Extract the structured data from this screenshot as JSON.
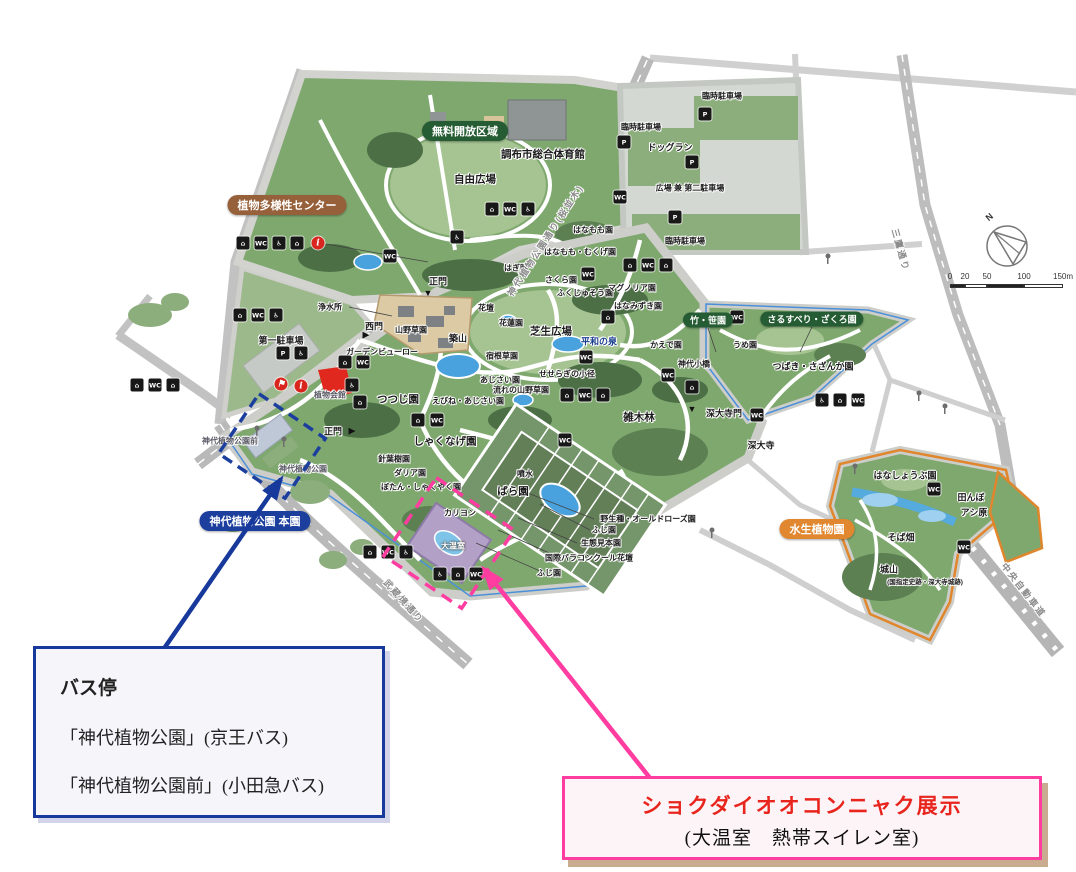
{
  "figure": {
    "width": 1076,
    "height": 872
  },
  "colors": {
    "park_green": "#7fa86f",
    "lawn_green": "#a5c492",
    "tree_green": "#4c6f45",
    "parking_grey": "#d4d8d2",
    "water_blue": "#49a2de",
    "accent_blue": "#16399b",
    "accent_pink": "#ff3da0",
    "red_text": "#e8251d",
    "orange_border": "#e0862c",
    "pill_green": "#265c33",
    "pill_brown": "#96603a",
    "pill_blue": "#1c3f9e",
    "pill_orange": "#e1872f"
  },
  "pills": [
    {
      "t": "無料開放区域",
      "x": 465,
      "y": 131,
      "bg": "#265c33",
      "n": "free-open-area-pill"
    },
    {
      "t": "植物多様性センター",
      "x": 287,
      "y": 205,
      "bg": "#96603a",
      "n": "biodiversity-center-pill"
    },
    {
      "t": "竹・笹園",
      "x": 708,
      "y": 320,
      "bg": "#265c33",
      "small": true,
      "n": "bamboo-garden-pill"
    },
    {
      "t": "さるすべり・ざくろ園",
      "x": 812,
      "y": 319,
      "bg": "#265c33",
      "small": true,
      "n": "crape-myrtle-garden-pill"
    },
    {
      "t": "神代植物公園 本園",
      "x": 255,
      "y": 521,
      "bg": "#1c3f9e",
      "n": "main-garden-pill"
    },
    {
      "t": "水生植物園",
      "x": 817,
      "y": 529,
      "bg": "#e1872f",
      "n": "aquatic-garden-pill"
    }
  ],
  "map": {
    "labels": [
      {
        "t": "臨時駐車場",
        "x": 722,
        "y": 96,
        "c": "s8"
      },
      {
        "t": "臨時駐車場",
        "x": 641,
        "y": 127,
        "c": "s8"
      },
      {
        "t": "ドッグラン",
        "x": 670,
        "y": 147
      },
      {
        "t": "広場 兼 第二駐車場",
        "x": 690,
        "y": 188,
        "c": "s8"
      },
      {
        "t": "臨時駐車場",
        "x": 685,
        "y": 241,
        "c": "s8"
      },
      {
        "t": "調布市総合体育館",
        "x": 543,
        "y": 154,
        "c": "s10"
      },
      {
        "t": "自由広場",
        "x": 475,
        "y": 179,
        "c": "s10"
      },
      {
        "t": "はなもも園",
        "x": 593,
        "y": 230,
        "c": "s8"
      },
      {
        "t": "はなもも・むくげ園",
        "x": 580,
        "y": 252,
        "c": "s8"
      },
      {
        "t": "はぎ園",
        "x": 516,
        "y": 268,
        "c": "s8"
      },
      {
        "t": "さくら園",
        "x": 561,
        "y": 280,
        "c": "s8"
      },
      {
        "t": "ふくじゅそう園",
        "x": 585,
        "y": 293,
        "c": "s8"
      },
      {
        "t": "マグノリア園",
        "x": 632,
        "y": 288,
        "c": "s8"
      },
      {
        "t": "はなみずき園",
        "x": 638,
        "y": 306,
        "c": "s8"
      },
      {
        "t": "正門",
        "x": 438,
        "y": 281
      },
      {
        "t": "▼",
        "x": 428,
        "y": 293,
        "c": "tri"
      },
      {
        "t": "西門",
        "x": 374,
        "y": 326
      },
      {
        "t": "▶",
        "x": 366,
        "y": 335,
        "c": "tri"
      },
      {
        "t": "浄水所",
        "x": 330,
        "y": 307,
        "c": "s8"
      },
      {
        "t": "第一駐車場",
        "x": 281,
        "y": 340
      },
      {
        "t": "ガーデンビューロー",
        "x": 382,
        "y": 352,
        "c": "s8"
      },
      {
        "t": "植物会館",
        "x": 330,
        "y": 395,
        "c": "g8"
      },
      {
        "t": "山野草園",
        "x": 411,
        "y": 330,
        "c": "s8"
      },
      {
        "t": "築山",
        "x": 458,
        "y": 338
      },
      {
        "t": "花壇",
        "x": 486,
        "y": 308,
        "c": "s8"
      },
      {
        "t": "花蓮園",
        "x": 511,
        "y": 323,
        "c": "s8"
      },
      {
        "t": "芝生広場",
        "x": 551,
        "y": 331,
        "c": "s10"
      },
      {
        "t": "宿根草園",
        "x": 502,
        "y": 356,
        "c": "s8"
      },
      {
        "t": "平和の泉",
        "x": 599,
        "y": 341,
        "c": "navy"
      },
      {
        "t": "あじさい園",
        "x": 500,
        "y": 380,
        "c": "s8"
      },
      {
        "t": "流れの山野草園",
        "x": 521,
        "y": 390,
        "c": "s8"
      },
      {
        "t": "えびね・あじさい園",
        "x": 468,
        "y": 401,
        "c": "s8"
      },
      {
        "t": "せせらぎの小径",
        "x": 567,
        "y": 374,
        "c": "s8"
      },
      {
        "t": "つつじ園",
        "x": 398,
        "y": 399,
        "c": "s10"
      },
      {
        "t": "しゃくなげ園",
        "x": 445,
        "y": 441,
        "c": "s10"
      },
      {
        "t": "針葉樹園",
        "x": 394,
        "y": 459,
        "c": "s8"
      },
      {
        "t": "ダリア園",
        "x": 410,
        "y": 473,
        "c": "s8"
      },
      {
        "t": "ぼたん・しゃくやく園",
        "x": 421,
        "y": 487,
        "c": "s8"
      },
      {
        "t": "噴水",
        "x": 525,
        "y": 474,
        "c": "s8"
      },
      {
        "t": "ばら園",
        "x": 513,
        "y": 491,
        "c": "s10"
      },
      {
        "t": "カリヨン",
        "x": 460,
        "y": 513,
        "c": "s8"
      },
      {
        "t": "大温室",
        "x": 453,
        "y": 546,
        "c": "w8"
      },
      {
        "t": "野生種・オールドローズ園",
        "x": 648,
        "y": 519,
        "c": "s8"
      },
      {
        "t": "ふじ園",
        "x": 604,
        "y": 530,
        "c": "s8"
      },
      {
        "t": "生態見本園",
        "x": 601,
        "y": 543,
        "c": "s8"
      },
      {
        "t": "国際バラコンクール花壇",
        "x": 589,
        "y": 558,
        "c": "s8"
      },
      {
        "t": "ふじ園",
        "x": 549,
        "y": 573,
        "c": "s8"
      },
      {
        "t": "雑木林",
        "x": 639,
        "y": 417,
        "c": "s10"
      },
      {
        "t": "深大寺門",
        "x": 724,
        "y": 413
      },
      {
        "t": "▼",
        "x": 692,
        "y": 409,
        "c": "tri"
      },
      {
        "t": "深大寺",
        "x": 761,
        "y": 445
      },
      {
        "t": "かえで園",
        "x": 666,
        "y": 345,
        "c": "s8"
      },
      {
        "t": "神代小橋",
        "x": 694,
        "y": 364,
        "c": "s8"
      },
      {
        "t": "うめ園",
        "x": 745,
        "y": 345,
        "c": "s8"
      },
      {
        "t": "つばき・さざんか園",
        "x": 813,
        "y": 366
      },
      {
        "t": "はなしょうぶ園",
        "x": 905,
        "y": 475
      },
      {
        "t": "田んぼ",
        "x": 971,
        "y": 497
      },
      {
        "t": "アシ原",
        "x": 974,
        "y": 512
      },
      {
        "t": "そば畑",
        "x": 901,
        "y": 537
      },
      {
        "t": "城山",
        "x": 889,
        "y": 569
      },
      {
        "t": "(国指定史跡・深大寺城跡)",
        "x": 925,
        "y": 581,
        "c": "s7"
      },
      {
        "t": "正門",
        "x": 333,
        "y": 431
      },
      {
        "t": "▶",
        "x": 352,
        "y": 431,
        "c": "tri"
      },
      {
        "t": "神代植物公園前",
        "x": 230,
        "y": 441,
        "c": "g8"
      },
      {
        "t": "神代植物公園",
        "x": 303,
        "y": 469,
        "c": "g8"
      },
      {
        "t": "神代植物公園通り(桜並木)",
        "x": 545,
        "y": 240,
        "c": "road",
        "r": -57
      },
      {
        "t": "三鷹通り",
        "x": 901,
        "y": 250,
        "c": "road",
        "r": 74
      },
      {
        "t": "武蔵境通り",
        "x": 404,
        "y": 601,
        "c": "road",
        "r": 48
      },
      {
        "t": "中央自動車道",
        "x": 1024,
        "y": 590,
        "c": "road",
        "r": 52
      }
    ],
    "icons": [
      {
        "n": "facility-icon",
        "g": "⌂",
        "x": 243,
        "y": 243
      },
      {
        "n": "toilet-icon",
        "g": "WC",
        "x": 261,
        "y": 243
      },
      {
        "n": "accessible-icon",
        "g": "♿",
        "x": 279,
        "y": 243
      },
      {
        "n": "facility-icon",
        "g": "⌂",
        "x": 297,
        "y": 243
      },
      {
        "n": "info-icon",
        "g": "i",
        "x": 318,
        "y": 243,
        "red": true
      },
      {
        "n": "facility-icon",
        "g": "⌂",
        "x": 240,
        "y": 315
      },
      {
        "n": "toilet-icon",
        "g": "WC",
        "x": 258,
        "y": 315
      },
      {
        "n": "accessible-icon",
        "g": "♿",
        "x": 276,
        "y": 315
      },
      {
        "n": "parking-icon",
        "g": "P",
        "x": 283,
        "y": 353
      },
      {
        "n": "accessible-icon",
        "g": "♿",
        "x": 301,
        "y": 353
      },
      {
        "n": "facility-icon",
        "g": "⌂",
        "x": 137,
        "y": 385
      },
      {
        "n": "toilet-icon",
        "g": "WC",
        "x": 155,
        "y": 385
      },
      {
        "n": "facility-icon",
        "g": "⌂",
        "x": 173,
        "y": 385
      },
      {
        "n": "flag-icon",
        "g": "⚑",
        "x": 281,
        "y": 384,
        "red": true
      },
      {
        "n": "info-icon",
        "g": "i",
        "x": 301,
        "y": 386,
        "red": true
      },
      {
        "n": "toilet-icon",
        "g": "WC",
        "x": 390,
        "y": 256
      },
      {
        "n": "accessible-icon",
        "g": "♿",
        "x": 457,
        "y": 237
      },
      {
        "n": "facility-icon",
        "g": "⌂",
        "x": 492,
        "y": 209
      },
      {
        "n": "toilet-icon",
        "g": "WC",
        "x": 510,
        "y": 209
      },
      {
        "n": "accessible-icon",
        "g": "♿",
        "x": 528,
        "y": 209
      },
      {
        "n": "parking-icon",
        "g": "P",
        "x": 705,
        "y": 114
      },
      {
        "n": "parking-icon",
        "g": "P",
        "x": 624,
        "y": 142
      },
      {
        "n": "parking-icon",
        "g": "P",
        "x": 692,
        "y": 162
      },
      {
        "n": "parking-icon",
        "g": "P",
        "x": 675,
        "y": 217
      },
      {
        "n": "toilet-icon",
        "g": "WC",
        "x": 620,
        "y": 197
      },
      {
        "n": "facility-icon",
        "g": "⌂",
        "x": 630,
        "y": 265
      },
      {
        "n": "toilet-icon",
        "g": "WC",
        "x": 648,
        "y": 265
      },
      {
        "n": "facility-icon",
        "g": "⌂",
        "x": 666,
        "y": 265
      },
      {
        "n": "toilet-icon",
        "g": "WC",
        "x": 588,
        "y": 274
      },
      {
        "n": "facility-icon",
        "g": "⌂",
        "x": 608,
        "y": 317
      },
      {
        "n": "toilet-icon",
        "g": "WC",
        "x": 586,
        "y": 357
      },
      {
        "n": "facility-icon",
        "g": "⌂",
        "x": 345,
        "y": 362
      },
      {
        "n": "toilet-icon",
        "g": "WC",
        "x": 363,
        "y": 362
      },
      {
        "n": "accessible-icon",
        "g": "♿",
        "x": 352,
        "y": 385
      },
      {
        "n": "facility-icon",
        "g": "⌂",
        "x": 360,
        "y": 402
      },
      {
        "n": "facility-icon",
        "g": "⌂",
        "x": 418,
        "y": 420
      },
      {
        "n": "toilet-icon",
        "g": "WC",
        "x": 437,
        "y": 420
      },
      {
        "n": "toilet-icon",
        "g": "WC",
        "x": 565,
        "y": 440
      },
      {
        "n": "facility-icon",
        "g": "⌂",
        "x": 567,
        "y": 395
      },
      {
        "n": "toilet-icon",
        "g": "WC",
        "x": 585,
        "y": 395
      },
      {
        "n": "facility-icon",
        "g": "⌂",
        "x": 603,
        "y": 395
      },
      {
        "n": "toilet-icon",
        "g": "WC",
        "x": 668,
        "y": 375
      },
      {
        "n": "facility-icon",
        "g": "⌂",
        "x": 692,
        "y": 387
      },
      {
        "n": "toilet-icon",
        "g": "WC",
        "x": 757,
        "y": 415
      },
      {
        "n": "toilet-icon",
        "g": "WC",
        "x": 737,
        "y": 317
      },
      {
        "n": "accessible-icon",
        "g": "♿",
        "x": 822,
        "y": 400
      },
      {
        "n": "facility-icon",
        "g": "⌂",
        "x": 840,
        "y": 400
      },
      {
        "n": "toilet-icon",
        "g": "WC",
        "x": 858,
        "y": 400
      },
      {
        "n": "toilet-icon",
        "g": "WC",
        "x": 934,
        "y": 489
      },
      {
        "n": "toilet-icon",
        "g": "WC",
        "x": 964,
        "y": 547
      },
      {
        "n": "accessible-icon",
        "g": "♿",
        "x": 440,
        "y": 574
      },
      {
        "n": "facility-icon",
        "g": "⌂",
        "x": 458,
        "y": 574
      },
      {
        "n": "toilet-icon",
        "g": "WC",
        "x": 476,
        "y": 574
      },
      {
        "n": "facility-icon",
        "g": "⌂",
        "x": 370,
        "y": 552
      },
      {
        "n": "toilet-icon",
        "g": "WC",
        "x": 388,
        "y": 552
      },
      {
        "n": "accessible-icon",
        "g": "♿",
        "x": 406,
        "y": 552
      }
    ]
  },
  "callouts": {
    "bus": {
      "title": "バス停",
      "line1": "「神代植物公園」(京王バス)",
      "line2": "「神代植物公園前」(小田急バス)"
    },
    "konjac": {
      "line1": "ショクダイオオコンニャク展示",
      "line2": "(大温室　熱帯スイレン室)"
    }
  },
  "compass": {
    "label": "N"
  },
  "scalebar": {
    "ticks": [
      {
        "t": "0",
        "x": 2
      },
      {
        "t": "20",
        "x": 17
      },
      {
        "t": "50",
        "x": 39
      },
      {
        "t": "100",
        "x": 76
      },
      {
        "t": "150m",
        "x": 115
      }
    ]
  }
}
